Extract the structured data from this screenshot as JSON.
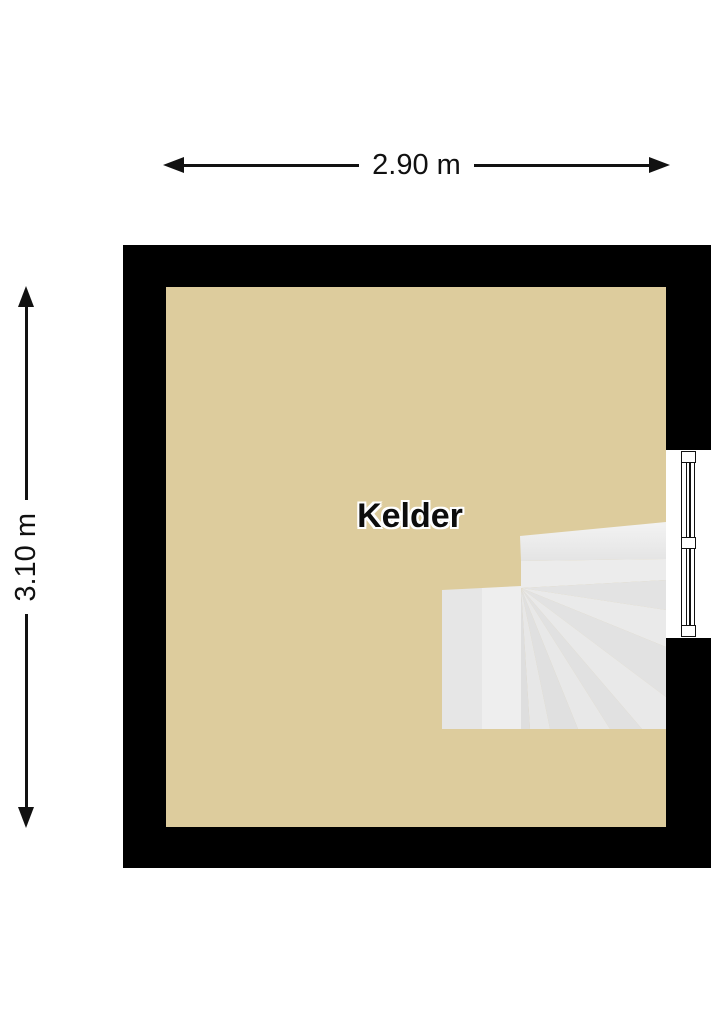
{
  "colors": {
    "background": "#ffffff",
    "wall": "#000000",
    "floor": "#ddcc9d",
    "stair_light": "#ededed",
    "stair_shadow": "#dfdfdf",
    "line": "#111111"
  },
  "floorplan": {
    "room": {
      "label": "Kelder"
    },
    "dimensions": {
      "width": {
        "label": "2.90 m"
      },
      "height": {
        "label": "3.10 m"
      }
    },
    "features": {
      "window_icon": "window-symbol-right-wall",
      "stairs_icon": "winder-stairs-bottom-right"
    }
  }
}
